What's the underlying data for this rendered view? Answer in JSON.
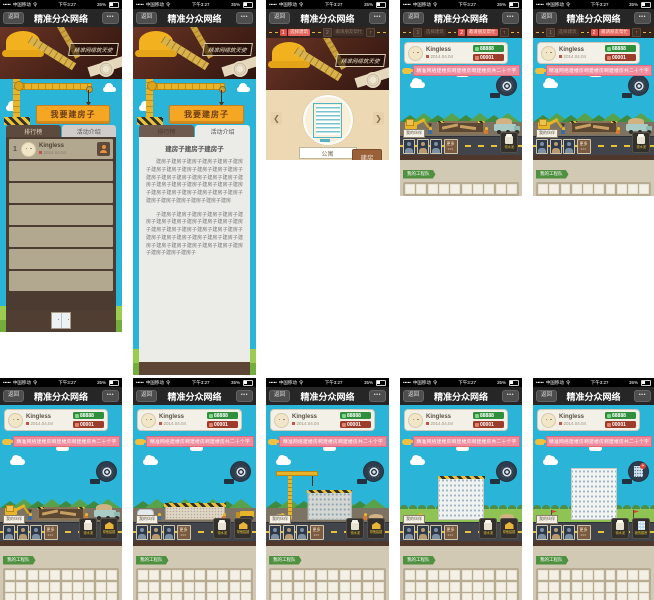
{
  "status_bar": {
    "signal": "•••••",
    "carrier": "中国移动",
    "wifi": "令",
    "time": "下午3:27",
    "battery_pct": "35%"
  },
  "nav": {
    "back": "返回",
    "title": "精准分众网络",
    "more": "•••"
  },
  "banner": {
    "tagline": "精准网络筑天使"
  },
  "crane": {
    "sign": "我要建房子"
  },
  "tabs": {
    "ranking": "排行榜",
    "intro": "活动介绍"
  },
  "ranking": {
    "rank1": "1",
    "name": "Kingless",
    "date": "2014.04.04"
  },
  "intro": {
    "title": "建房子建房子建房子",
    "para1": "建房子建房子建房子建房子建房子建房子建房子建房子建房子建房子建房子建房子建房子建房子建房子建房子建房子建房子建房子建房子建房子建房子建房子建房子建房子建房子建房子建房子建房子建房子建房子建房子建房子建房子建房子建房子建房",
    "para2": "子建房子建房子建房子建房子建房子建房子建房子建房子建房子建房子建房子建房子建房子建房子建房子建房子建房子建房子建房子建房子建房子建房子建房子建房子建房子建房子建房子建房子建房子建房子建房子建房子建房子建房子"
  },
  "steps": {
    "n1": "1",
    "label1": "选择建筑",
    "n2": "2",
    "label2": "邀请朋友帮忙",
    "collapse": "↑"
  },
  "select": {
    "prev": "❮",
    "next": "❯",
    "building_name": "公寓",
    "build_btn": "建房"
  },
  "player": {
    "name": "Kingless",
    "date": "2014.04.04",
    "coins": "88888",
    "count": "00001"
  },
  "ribbon": {
    "text": "精准网络建楼房啊建楼房啊建楼房共二十个字"
  },
  "game": {
    "partners_label": "我的伙伴",
    "more_label": "更多",
    "more_dots": "•••",
    "team_label": "我的工程队",
    "pedestal1_label": "领水泥",
    "pedestal2_label": "帮他建楼",
    "pedestal_building_label": "我的楼房"
  }
}
